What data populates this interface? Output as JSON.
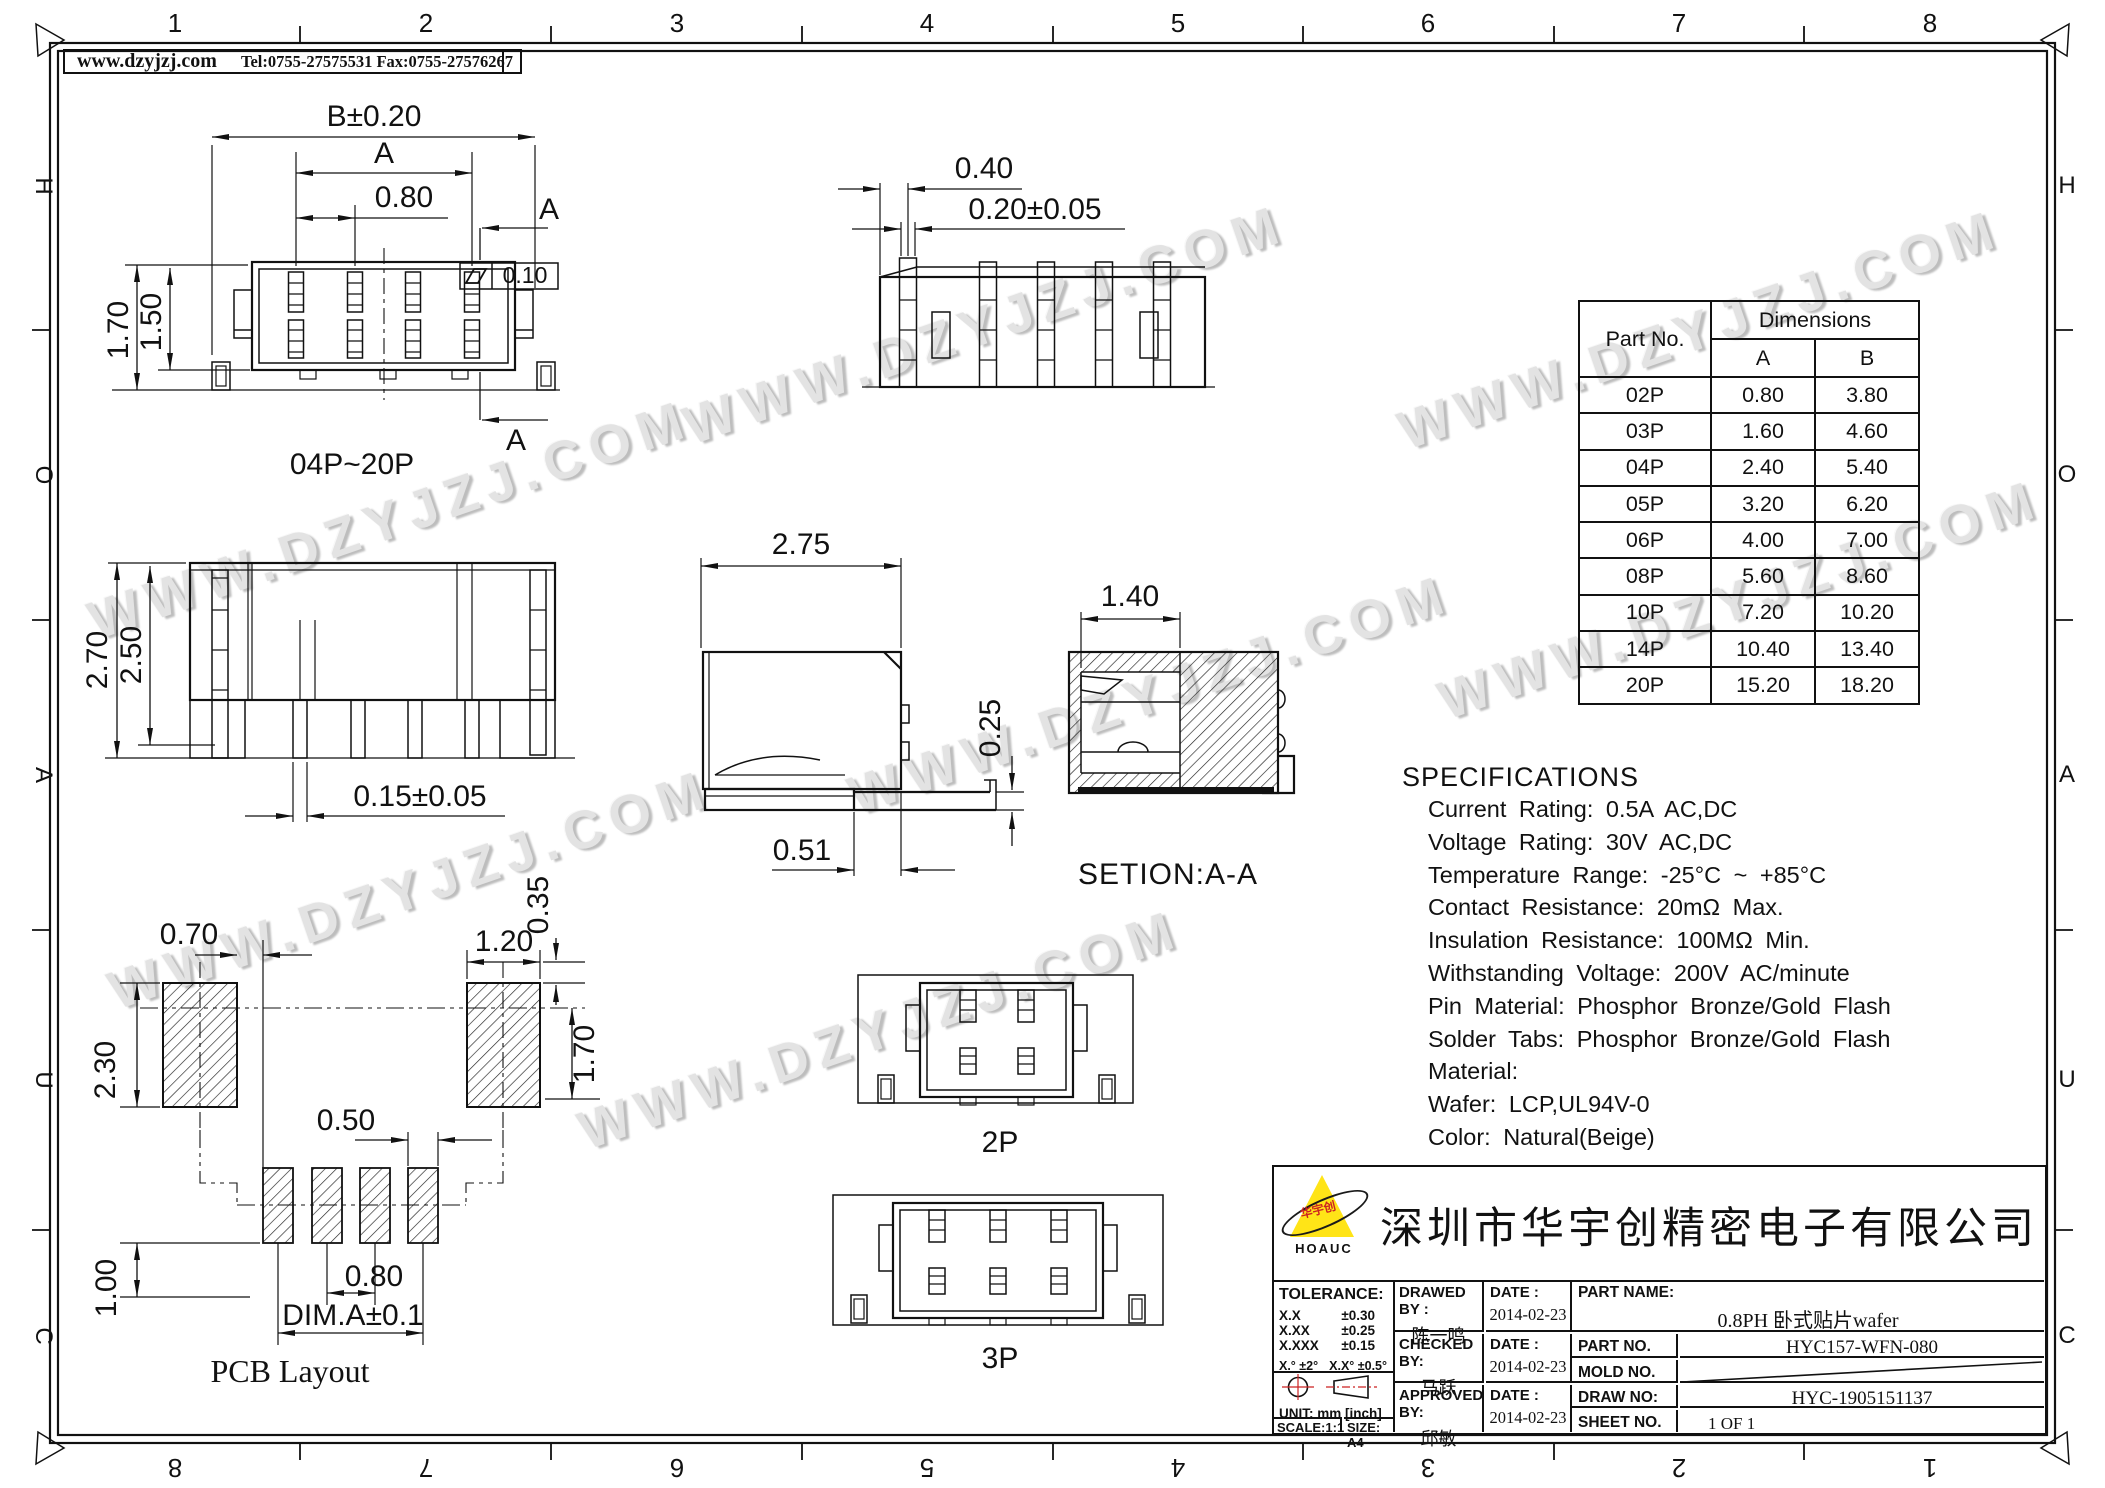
{
  "watermark": {
    "text": "WWW.DZYJZJ.COM"
  },
  "header": {
    "site": "www.dzyjzj.com",
    "contact": "Tel:0755-27575531  Fax:0755-27576267"
  },
  "ruler": {
    "top": [
      "1",
      "2",
      "3",
      "4",
      "5",
      "6",
      "7",
      "8"
    ],
    "bottom": [
      "8",
      "7",
      "6",
      "5",
      "4",
      "3",
      "2",
      "1"
    ],
    "left": [
      "H",
      "O",
      "A",
      "U",
      "C"
    ],
    "right": [
      "H",
      "O",
      "A",
      "U",
      "C"
    ]
  },
  "views": {
    "front": {
      "label": "04P~20P",
      "dim_b": "B±0.20",
      "dim_a": "A",
      "dim_pitch": "0.80",
      "dim_h_total": "1.70",
      "dim_h_body": "1.50",
      "section_mark": "A",
      "flatness": "0.10"
    },
    "comb": {
      "dim_tip": "0.40",
      "dim_tip_tol": "0.20±0.05"
    },
    "side": {
      "dim_h_total": "2.70",
      "dim_h_body": "2.50",
      "dim_pin": "0.15±0.05"
    },
    "profile": {
      "dim_w": "2.75",
      "dim_tab": "0.25",
      "dim_foot": "0.51"
    },
    "section": {
      "dim_w": "1.40",
      "label": "SETION:A-A"
    },
    "pcb": {
      "label": "PCB Layout",
      "dim_pad_offset": "0.70",
      "dim_pad_w": "1.20",
      "dim_edge": "0.35",
      "dim_pad_h": "2.30",
      "dim_row": "1.70",
      "dim_sm_w": "0.50",
      "dim_sm_h": "1.00",
      "dim_pitch": "0.80",
      "dim_a": "DIM.A±0.1"
    },
    "p2": {
      "label": "2P"
    },
    "p3": {
      "label": "3P"
    }
  },
  "dim_table": {
    "part_header": "Part No.",
    "dims_header": "Dimensions",
    "col_a": "A",
    "col_b": "B",
    "rows": [
      {
        "part": "02P",
        "a": "0.80",
        "b": "3.80"
      },
      {
        "part": "03P",
        "a": "1.60",
        "b": "4.60"
      },
      {
        "part": "04P",
        "a": "2.40",
        "b": "5.40"
      },
      {
        "part": "05P",
        "a": "3.20",
        "b": "6.20"
      },
      {
        "part": "06P",
        "a": "4.00",
        "b": "7.00"
      },
      {
        "part": "08P",
        "a": "5.60",
        "b": "8.60"
      },
      {
        "part": "10P",
        "a": "7.20",
        "b": "10.20"
      },
      {
        "part": "14P",
        "a": "10.40",
        "b": "13.40"
      },
      {
        "part": "20P",
        "a": "15.20",
        "b": "18.20"
      }
    ]
  },
  "specs": {
    "title": "SPECIFICATIONS",
    "lines": [
      "Current Rating: 0.5A AC,DC",
      "Voltage Rating: 30V AC,DC",
      "Temperature Range: -25°C ~ +85°C",
      "Contact Resistance: 20mΩ Max.",
      "Insulation Resistance: 100MΩ Min.",
      "Withstanding Voltage: 200V AC/minute",
      "Pin Material: Phosphor Bronze/Gold Flash",
      "Solder Tabs: Phosphor Bronze/Gold Flash",
      "Material:",
      "Wafer: LCP,UL94V-0",
      "Color: Natural(Beige)"
    ]
  },
  "title_block": {
    "company": "深圳市华宇创精密电子有限公司",
    "logo": {
      "brand": "HOAUC",
      "cn": "华宇创"
    },
    "tolerance": {
      "title": "TOLERANCE:",
      "rows": [
        {
          "l": "X.X",
          "v": "±0.30"
        },
        {
          "l": "X.XX",
          "v": "±0.25"
        },
        {
          "l": "X.XXX",
          "v": "±0.15"
        }
      ],
      "angle1": "X.°  ±2°",
      "angle2": "X.X°  ±0.5°"
    },
    "unit": "UNIT:  mm  [inch]",
    "scale": "SCALE:1:1",
    "size": "SIZE:  A4",
    "drawed_label": "DRAWED BY :",
    "checked_label": "CHECKED BY:",
    "approved_label": "APPROVED BY:",
    "date_label": "DATE :",
    "drawed_name": "陈一鸣",
    "checked_name": "马跃",
    "approved_name": "邱敏",
    "drawed_date": "2014-02-23",
    "checked_date": "2014-02-23",
    "approved_date": "2014-02-23",
    "part_name_label": "PART NAME:",
    "part_name": "0.8PH 卧式贴片wafer",
    "part_no_label": "PART NO.",
    "part_no": "HYC157-WFN-080",
    "mold_no_label": "MOLD NO.",
    "draw_no_label": "DRAW NO:",
    "draw_no": "HYC-1905151137",
    "sheet_no_label": "SHEET NO.",
    "sheet_no": "1 OF 1"
  }
}
